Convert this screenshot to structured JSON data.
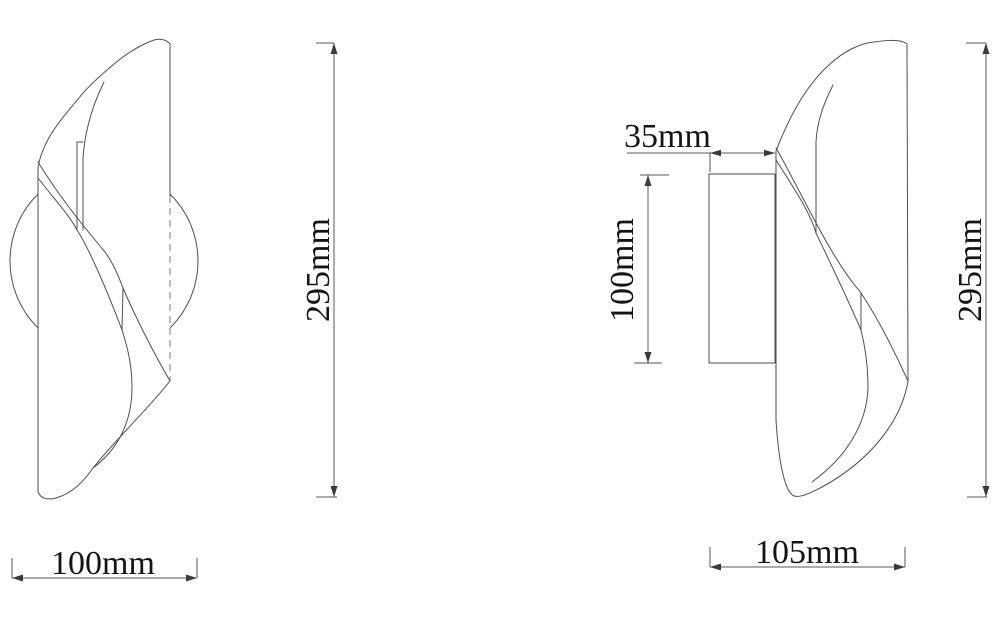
{
  "page": {
    "background": "#ffffff"
  },
  "drawing": {
    "front_view": {
      "height_dim": "295mm",
      "width_dim": "100mm"
    },
    "side_view": {
      "depth_dim": "35mm",
      "plate_height_dim": "100mm",
      "height_dim": "295mm",
      "width_dim": "105mm"
    },
    "colors": {
      "line": "#4f4f4f",
      "dim_line": "#5a5a5a",
      "text": "#141414"
    }
  }
}
